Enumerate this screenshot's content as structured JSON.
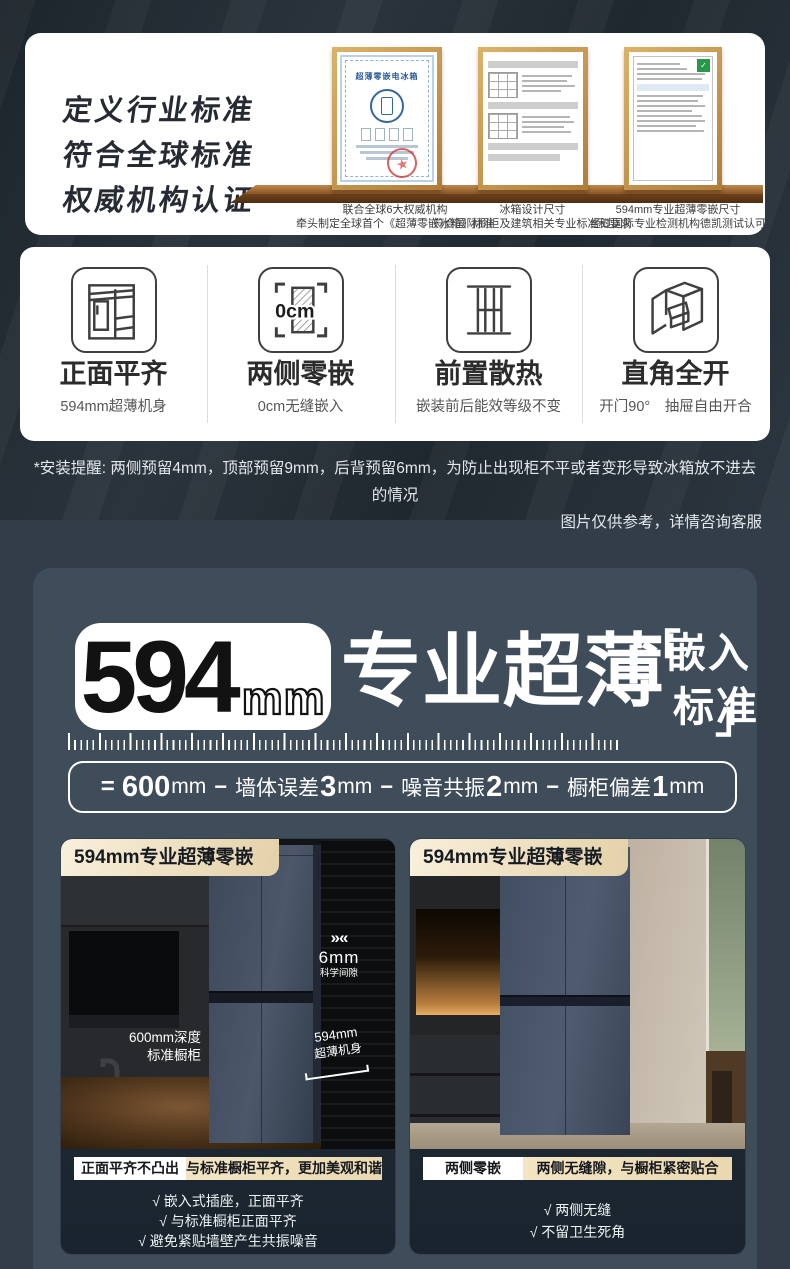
{
  "certs_section": {
    "headline": [
      "定义行业标准",
      "符合全球标准",
      "权威机构认证"
    ],
    "certificates": [
      {
        "title": "超薄零嵌电冰箱"
      }
    ],
    "captions": [
      {
        "line1": "联合全球6大权威机构",
        "line2": "牵头制定全球首个《超薄零嵌冰箱》标准"
      },
      {
        "line1": "冰箱设计尺寸",
        "line2": "符合国际橱柜及建筑相关专业标准和要求"
      },
      {
        "line1": "594mm专业超薄零嵌尺寸",
        "line2": "经过国际专业检测机构德凯测试认可"
      }
    ]
  },
  "features": [
    {
      "title": "正面平齐",
      "subtitle": "594mm超薄机身"
    },
    {
      "title": "两侧零嵌",
      "subtitle": "0cm无缝嵌入",
      "icon_text": "0cm"
    },
    {
      "title": "前置散热",
      "subtitle": "嵌装前后能效等级不变"
    },
    {
      "title": "直角全开",
      "subtitle": "开门90°　抽屉自由开合"
    }
  ],
  "install_note": {
    "line1": "*安装提醒: 两侧预留4mm，顶部预留9mm，后背预留6mm，为防止出现柜不平或者变形导致冰箱放不进去的情况",
    "line2": "图片仅供参考，详情咨询客服"
  },
  "hero": {
    "number": "594",
    "unit": "mm",
    "title": "专业超薄",
    "bracket_open": "「",
    "bracket_word1": "嵌入",
    "bracket_word2": "标准",
    "bracket_close": "」",
    "formula": {
      "eq": "=",
      "seg1_num": "600",
      "seg1_unit": "mm",
      "sep1": "−",
      "seg2_text": "墙体误差",
      "seg2_num": "3",
      "seg2_unit": "mm",
      "sep2": "−",
      "seg3_text": "噪音共振",
      "seg3_num": "2",
      "seg3_unit": "mm",
      "sep3": "−",
      "seg4_text": "橱柜偏差",
      "seg4_num": "1",
      "seg4_unit": "mm"
    }
  },
  "cards": [
    {
      "title": "594mm专业超薄零嵌",
      "brand": "Haier",
      "ann_depth1": "600mm深度",
      "ann_depth2": "标准橱柜",
      "ann_gap_chevron": "»«",
      "ann_gap_value": "6mm",
      "ann_gap_label": "科学间隙",
      "ann_body1": "594mm",
      "ann_body2": "超薄机身",
      "badge_white": "正面平齐不凸出",
      "badge_gold": "与标准橱柜平齐，更加美观和谐",
      "check": "√",
      "checks": [
        "嵌入式插座，正面平齐",
        "与标准橱柜正面平齐",
        "避免紧贴墙壁产生共振噪音"
      ]
    },
    {
      "title": "594mm专业超薄零嵌",
      "brand": "Haier",
      "badge_white": "两侧零嵌",
      "badge_gold": "两侧无缝隙，与橱柜紧密贴合",
      "check": "√",
      "checks": [
        "两侧无缝",
        "不留卫生死角"
      ]
    }
  ],
  "colors": {
    "accent_cream": "#e9d7b0",
    "panel": "#3f4c5a",
    "card_bg": "#1e2935",
    "wood": "#8a5326"
  }
}
